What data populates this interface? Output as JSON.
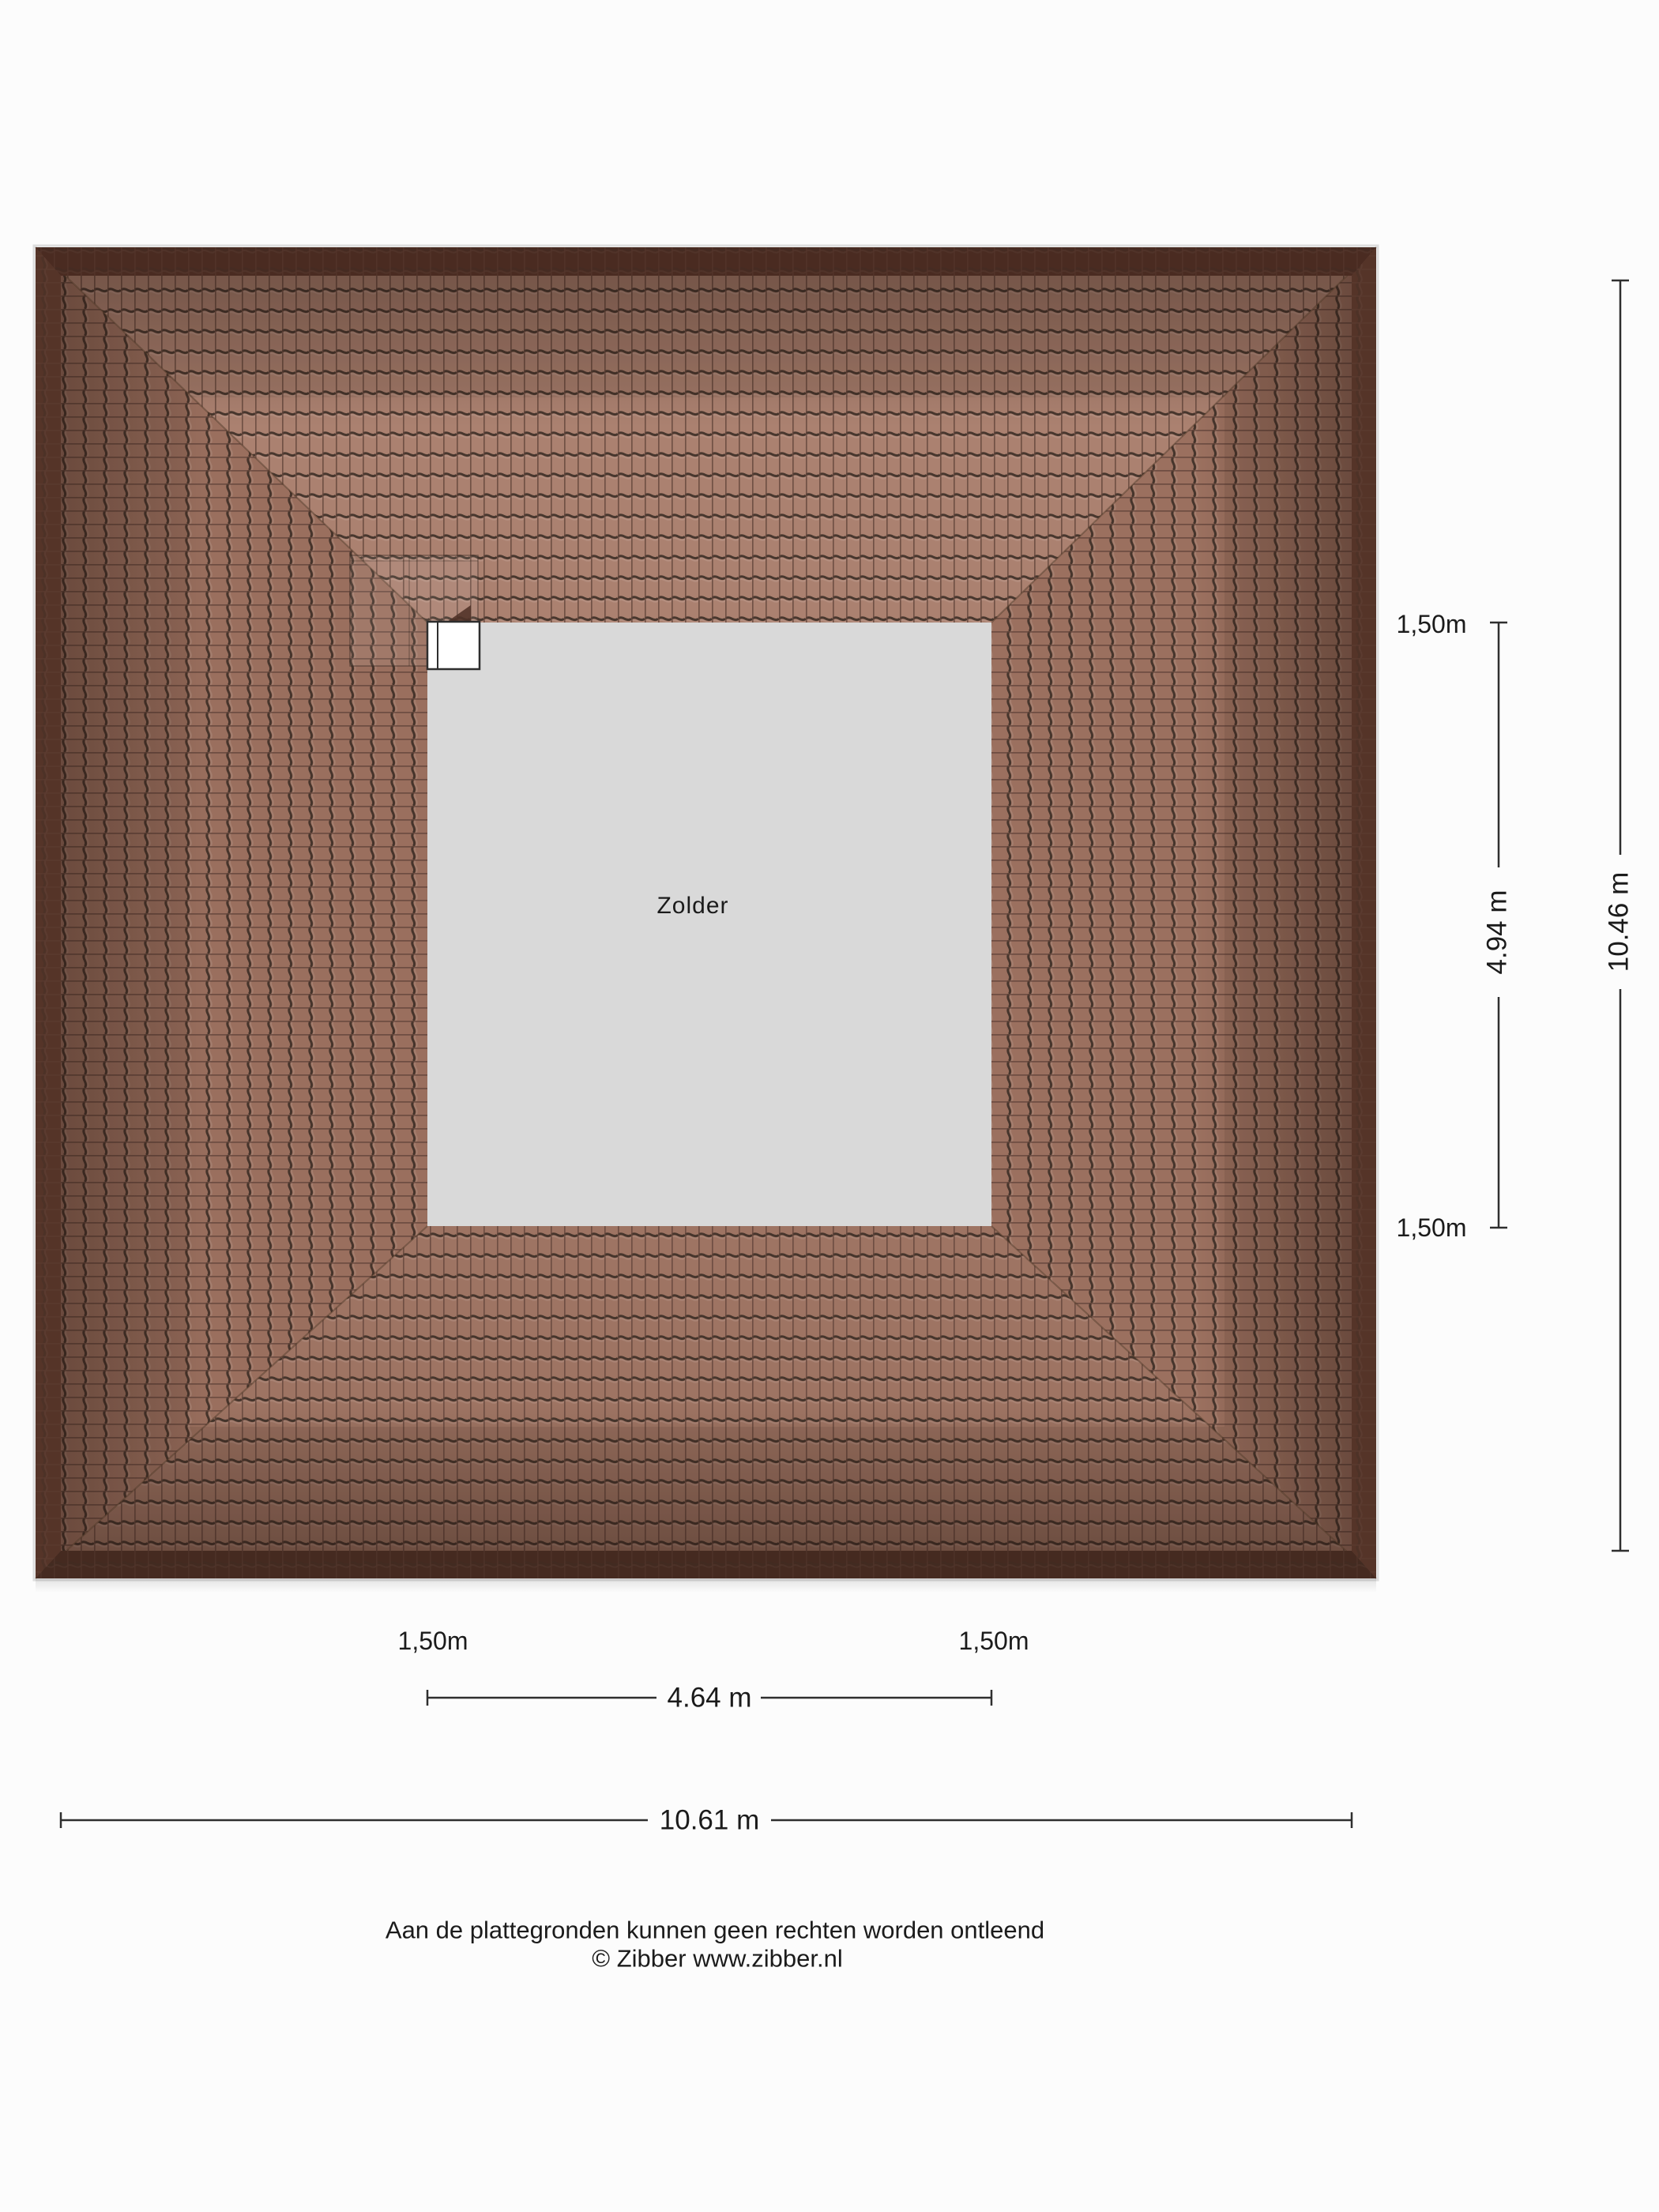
{
  "page": {
    "background": "#fcfcfc"
  },
  "plan": {
    "room_label": "Zolder",
    "dim_right_inner": "4.94 m",
    "dim_right_outer": "10.46 m",
    "dim_bottom_inner": "4.64 m",
    "dim_bottom_outer": "10.61 m",
    "height_contour_label": "1,50m",
    "colors": {
      "attic_floor": "#d9d9d9",
      "tile_top": "#ab8170",
      "tile_bottom": "#9e7463",
      "tile_left": "#9a6f5e",
      "tile_right": "#9b705f",
      "tile_line_dark": "#3a2c24",
      "tile_seam": "#63453a",
      "fascia_top": "#4a2b21",
      "fascia_bottom": "#452a20",
      "fascia_side": "#553428",
      "dimension_line": "#2f2f2f",
      "text": "#1b1b1b",
      "window_fill": "#ffffff",
      "window_frame": "#2e2e2e"
    }
  },
  "footer": {
    "line1": "Aan de plattegronden kunnen geen rechten worden ontleend",
    "line2": "© Zibber www.zibber.nl"
  }
}
